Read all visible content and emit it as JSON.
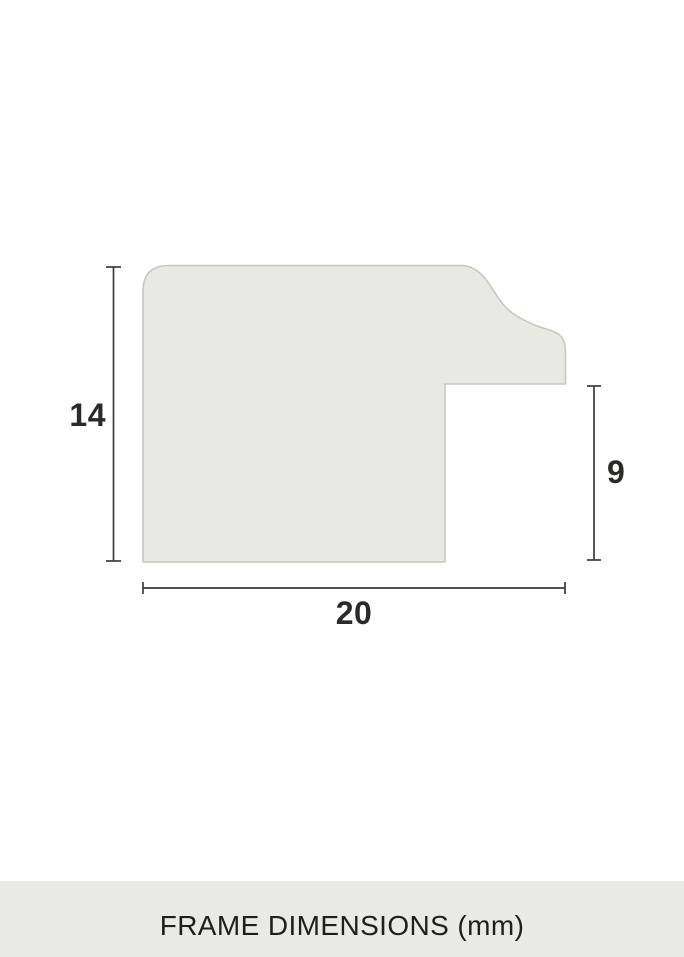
{
  "diagram": {
    "height_label": "14",
    "rabbet_label": "9",
    "width_label": "20"
  },
  "footer": {
    "caption": "FRAME DIMENSIONS (mm)"
  },
  "colors": {
    "background": "#ffffff",
    "profile_fill": "#e9e9e4",
    "profile_stroke": "#c8c8c2",
    "dimension_line": "#3c3c3a",
    "label_text": "#2a2a28",
    "footer_bg": "#e9e9e6",
    "footer_text": "#1f1f1d"
  }
}
